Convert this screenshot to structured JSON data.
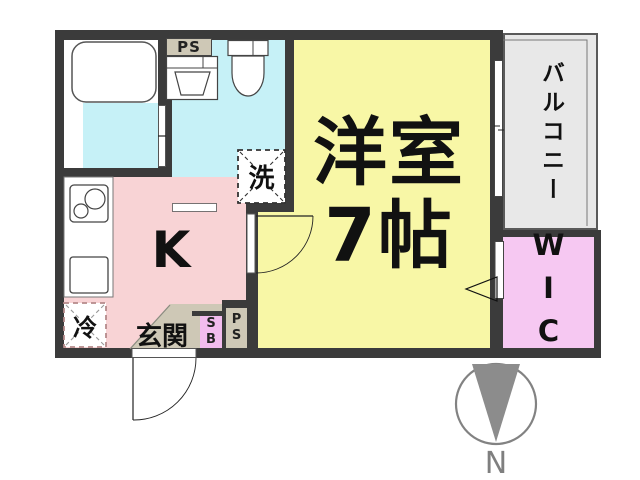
{
  "rooms": {
    "western": {
      "label_line1": "洋室",
      "label_line2": "7帖",
      "color": "#F8F7A6"
    },
    "kitchen": {
      "label": "K",
      "color": "#F8D3D5"
    },
    "entrance": {
      "label": "玄関",
      "color": "#CEC8B6"
    },
    "balcony": {
      "label": "バルコニー",
      "color": "#E8E8E8"
    },
    "wic": {
      "label": "WIC",
      "color": "#F6C8F2"
    },
    "wet_area_color": "#C6F1F7",
    "wall_color": "#3B3B3B"
  },
  "boxes": {
    "pipe_space_top": {
      "label": "PS"
    },
    "pipe_space_bottom": {
      "line1": "P",
      "line2": "S"
    },
    "shoe_box": {
      "line1": "S",
      "line2": "B"
    },
    "washing_machine": {
      "label": "洗"
    },
    "refrigerator": {
      "label": "冷"
    }
  },
  "compass": {
    "label": "N",
    "arrow_color": "#8C8C8C"
  }
}
